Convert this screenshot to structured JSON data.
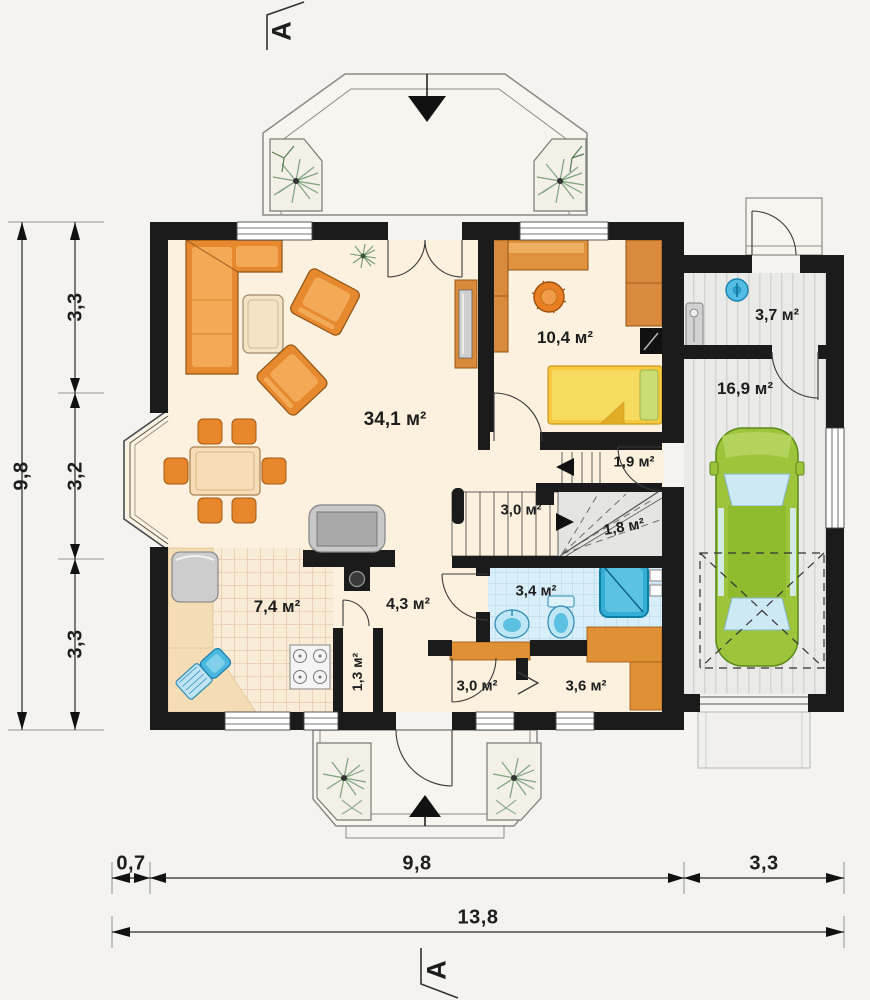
{
  "title": "Ground floor plan",
  "rooms": {
    "living": "34,1 м²",
    "bedroom": "10,4 м²",
    "boiler": "3,7 м²",
    "garage": "16,9 м²",
    "landing": "1,9 м²",
    "stairs": "3,0 м²",
    "understairs": "1,8 м²",
    "bathroom": "3,4 м²",
    "kitchen": "7,4 м²",
    "hall": "4,3 м²",
    "closet": "1,3 м²",
    "wardrobe_a": "3,0 м²",
    "wardrobe_b": "3,6 м²"
  },
  "dimensions": {
    "left_total": "9,8",
    "left_segments": [
      "3,3",
      "3,2",
      "3,3"
    ],
    "bottom_segments": [
      "0,7",
      "9,8",
      "3,3"
    ],
    "bottom_total": "13,8"
  },
  "section_markers": {
    "top": "A",
    "bottom": "A"
  },
  "colors": {
    "wall": "#1b1b1b",
    "floor": "#fcf1df",
    "furniture": "#e6892f",
    "car": "#9ec43b",
    "water_blue": "#45b8e2",
    "garage_floor": "#eaeae8",
    "bath_tile": "#d8eef8"
  }
}
